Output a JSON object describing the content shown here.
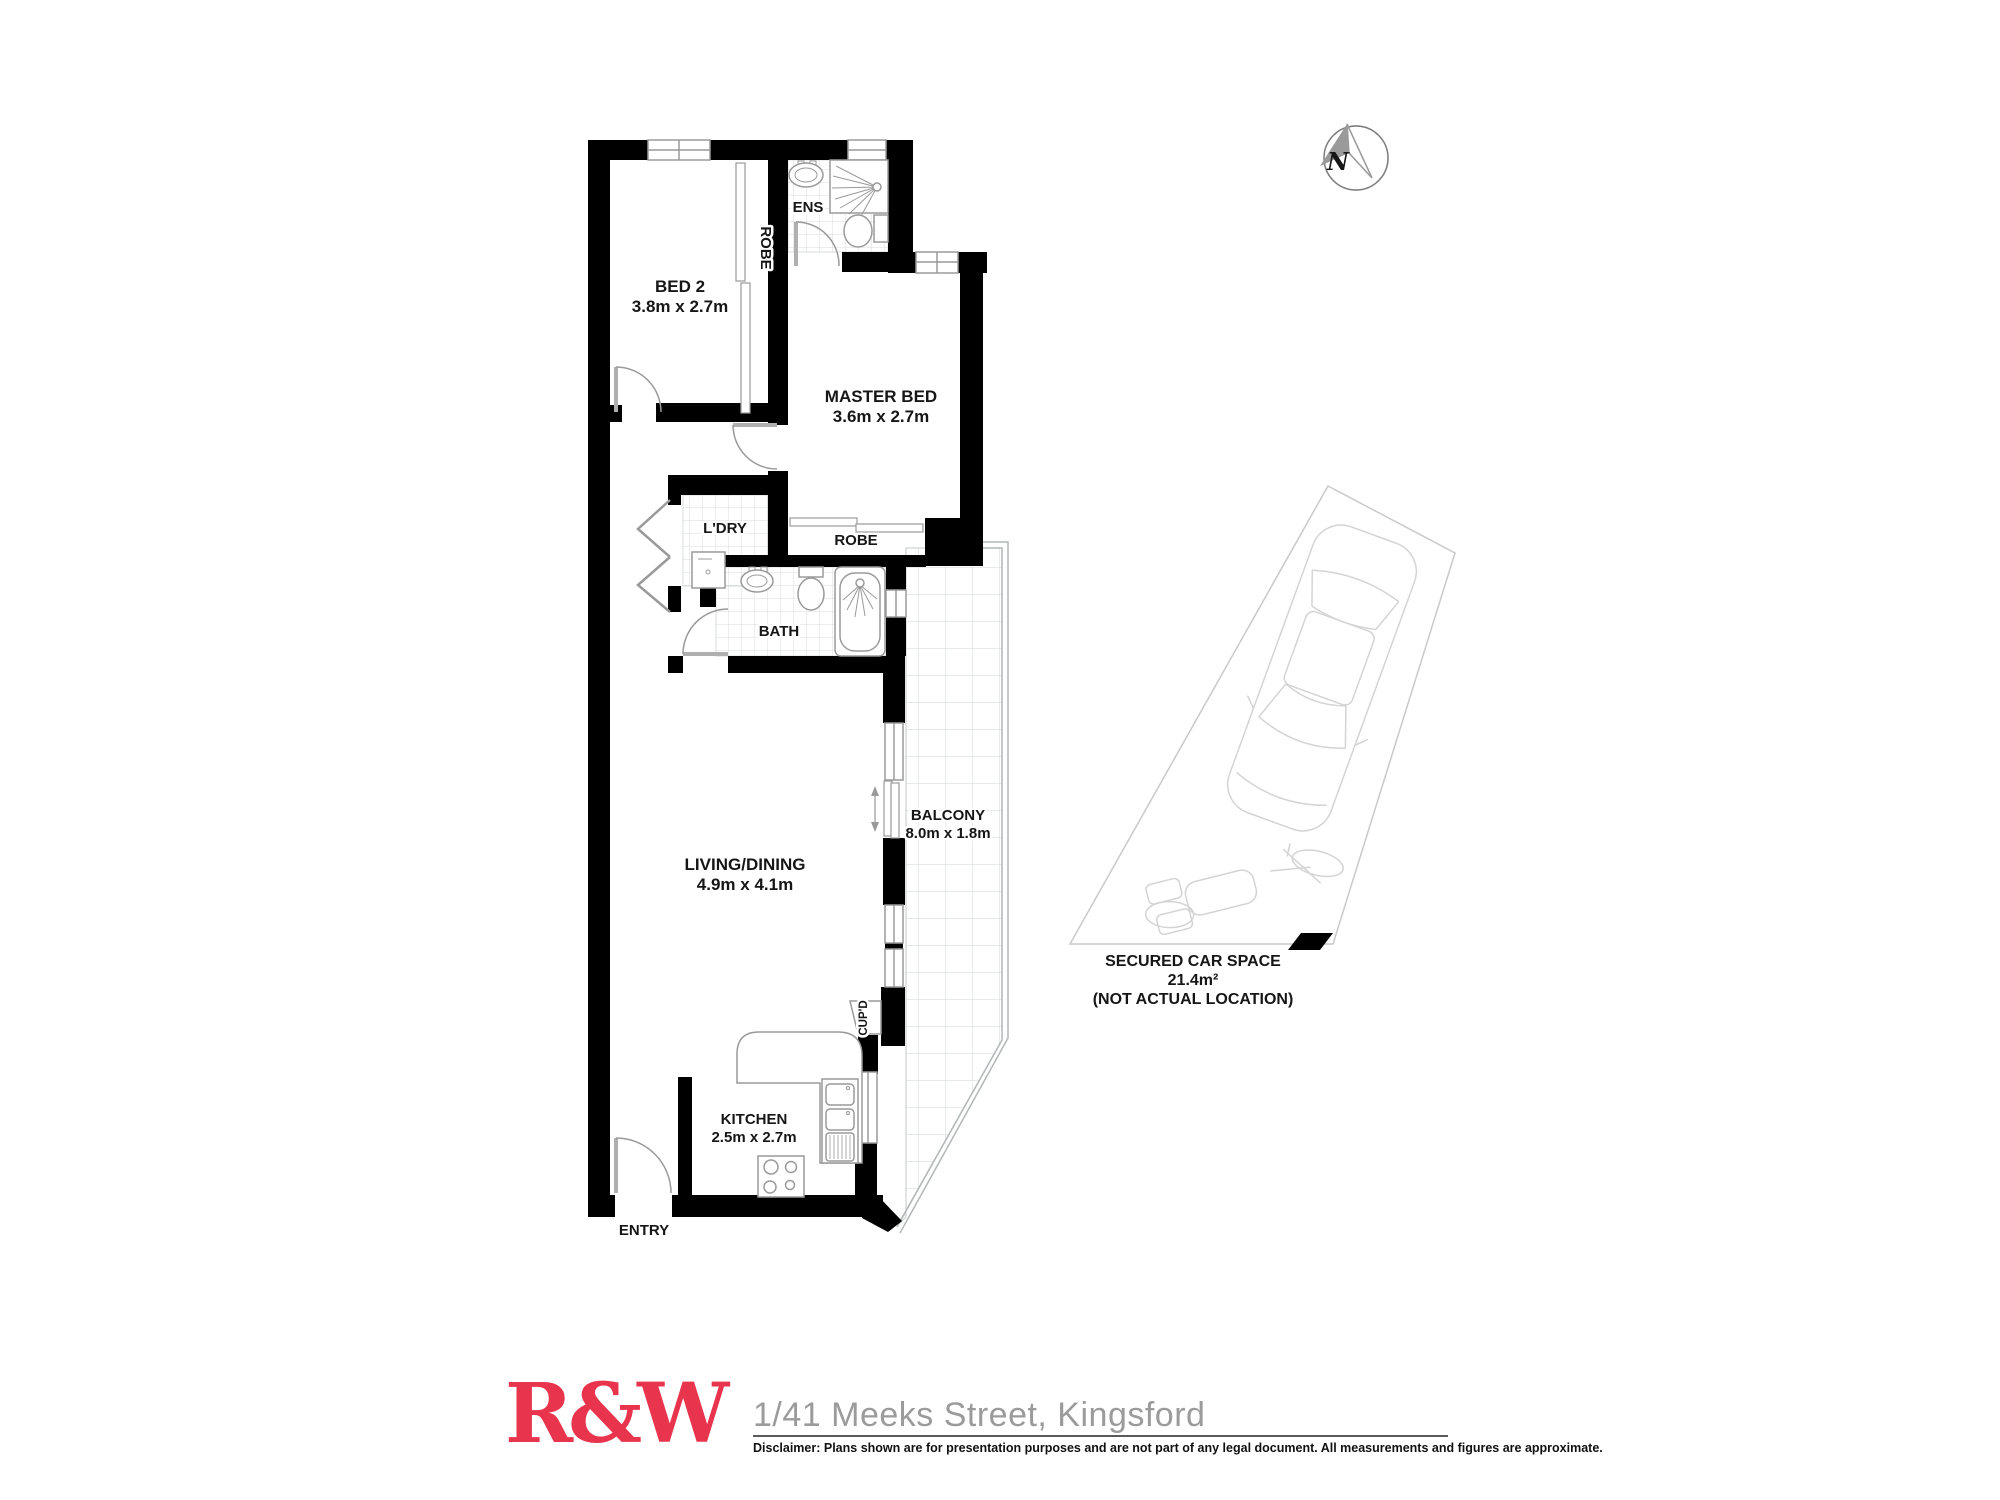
{
  "floorplan": {
    "rooms": {
      "bed2": {
        "name": "BED 2",
        "dims": "3.8m x 2.7m"
      },
      "master": {
        "name": "MASTER BED",
        "dims": "3.6m x 2.7m"
      },
      "living": {
        "name": "LIVING/DINING",
        "dims": "4.9m x 4.1m"
      },
      "kitchen": {
        "name": "KITCHEN",
        "dims": "2.5m x 2.7m"
      },
      "balcony": {
        "name": "BALCONY",
        "dims": "8.0m x 1.8m"
      }
    },
    "labels": {
      "ens": "ENS",
      "bed2_robe": "ROBE",
      "master_robe": "ROBE",
      "laundry": "L'DRY",
      "bath": "BATH",
      "cupboard": "CUP'D",
      "entry": "ENTRY"
    },
    "car_space": {
      "title": "SECURED CAR SPACE",
      "area": "21.4m²",
      "note": "(NOT ACTUAL LOCATION)"
    },
    "compass": {
      "label": "N"
    }
  },
  "footer": {
    "logo": "R&W",
    "address": "1/41 Meeks Street, Kingsford",
    "disclaimer": "Disclaimer: Plans shown are for presentation purposes and are not part of any legal document. All measurements and figures are approximate."
  },
  "colors": {
    "wall": "#000000",
    "fixture_gray": "#9a9a9a",
    "tile_gray": "#d8dcdc",
    "faint_gray": "#d4d4d4",
    "logo_red": "#e8354d",
    "address_gray": "#9b9b9b"
  }
}
